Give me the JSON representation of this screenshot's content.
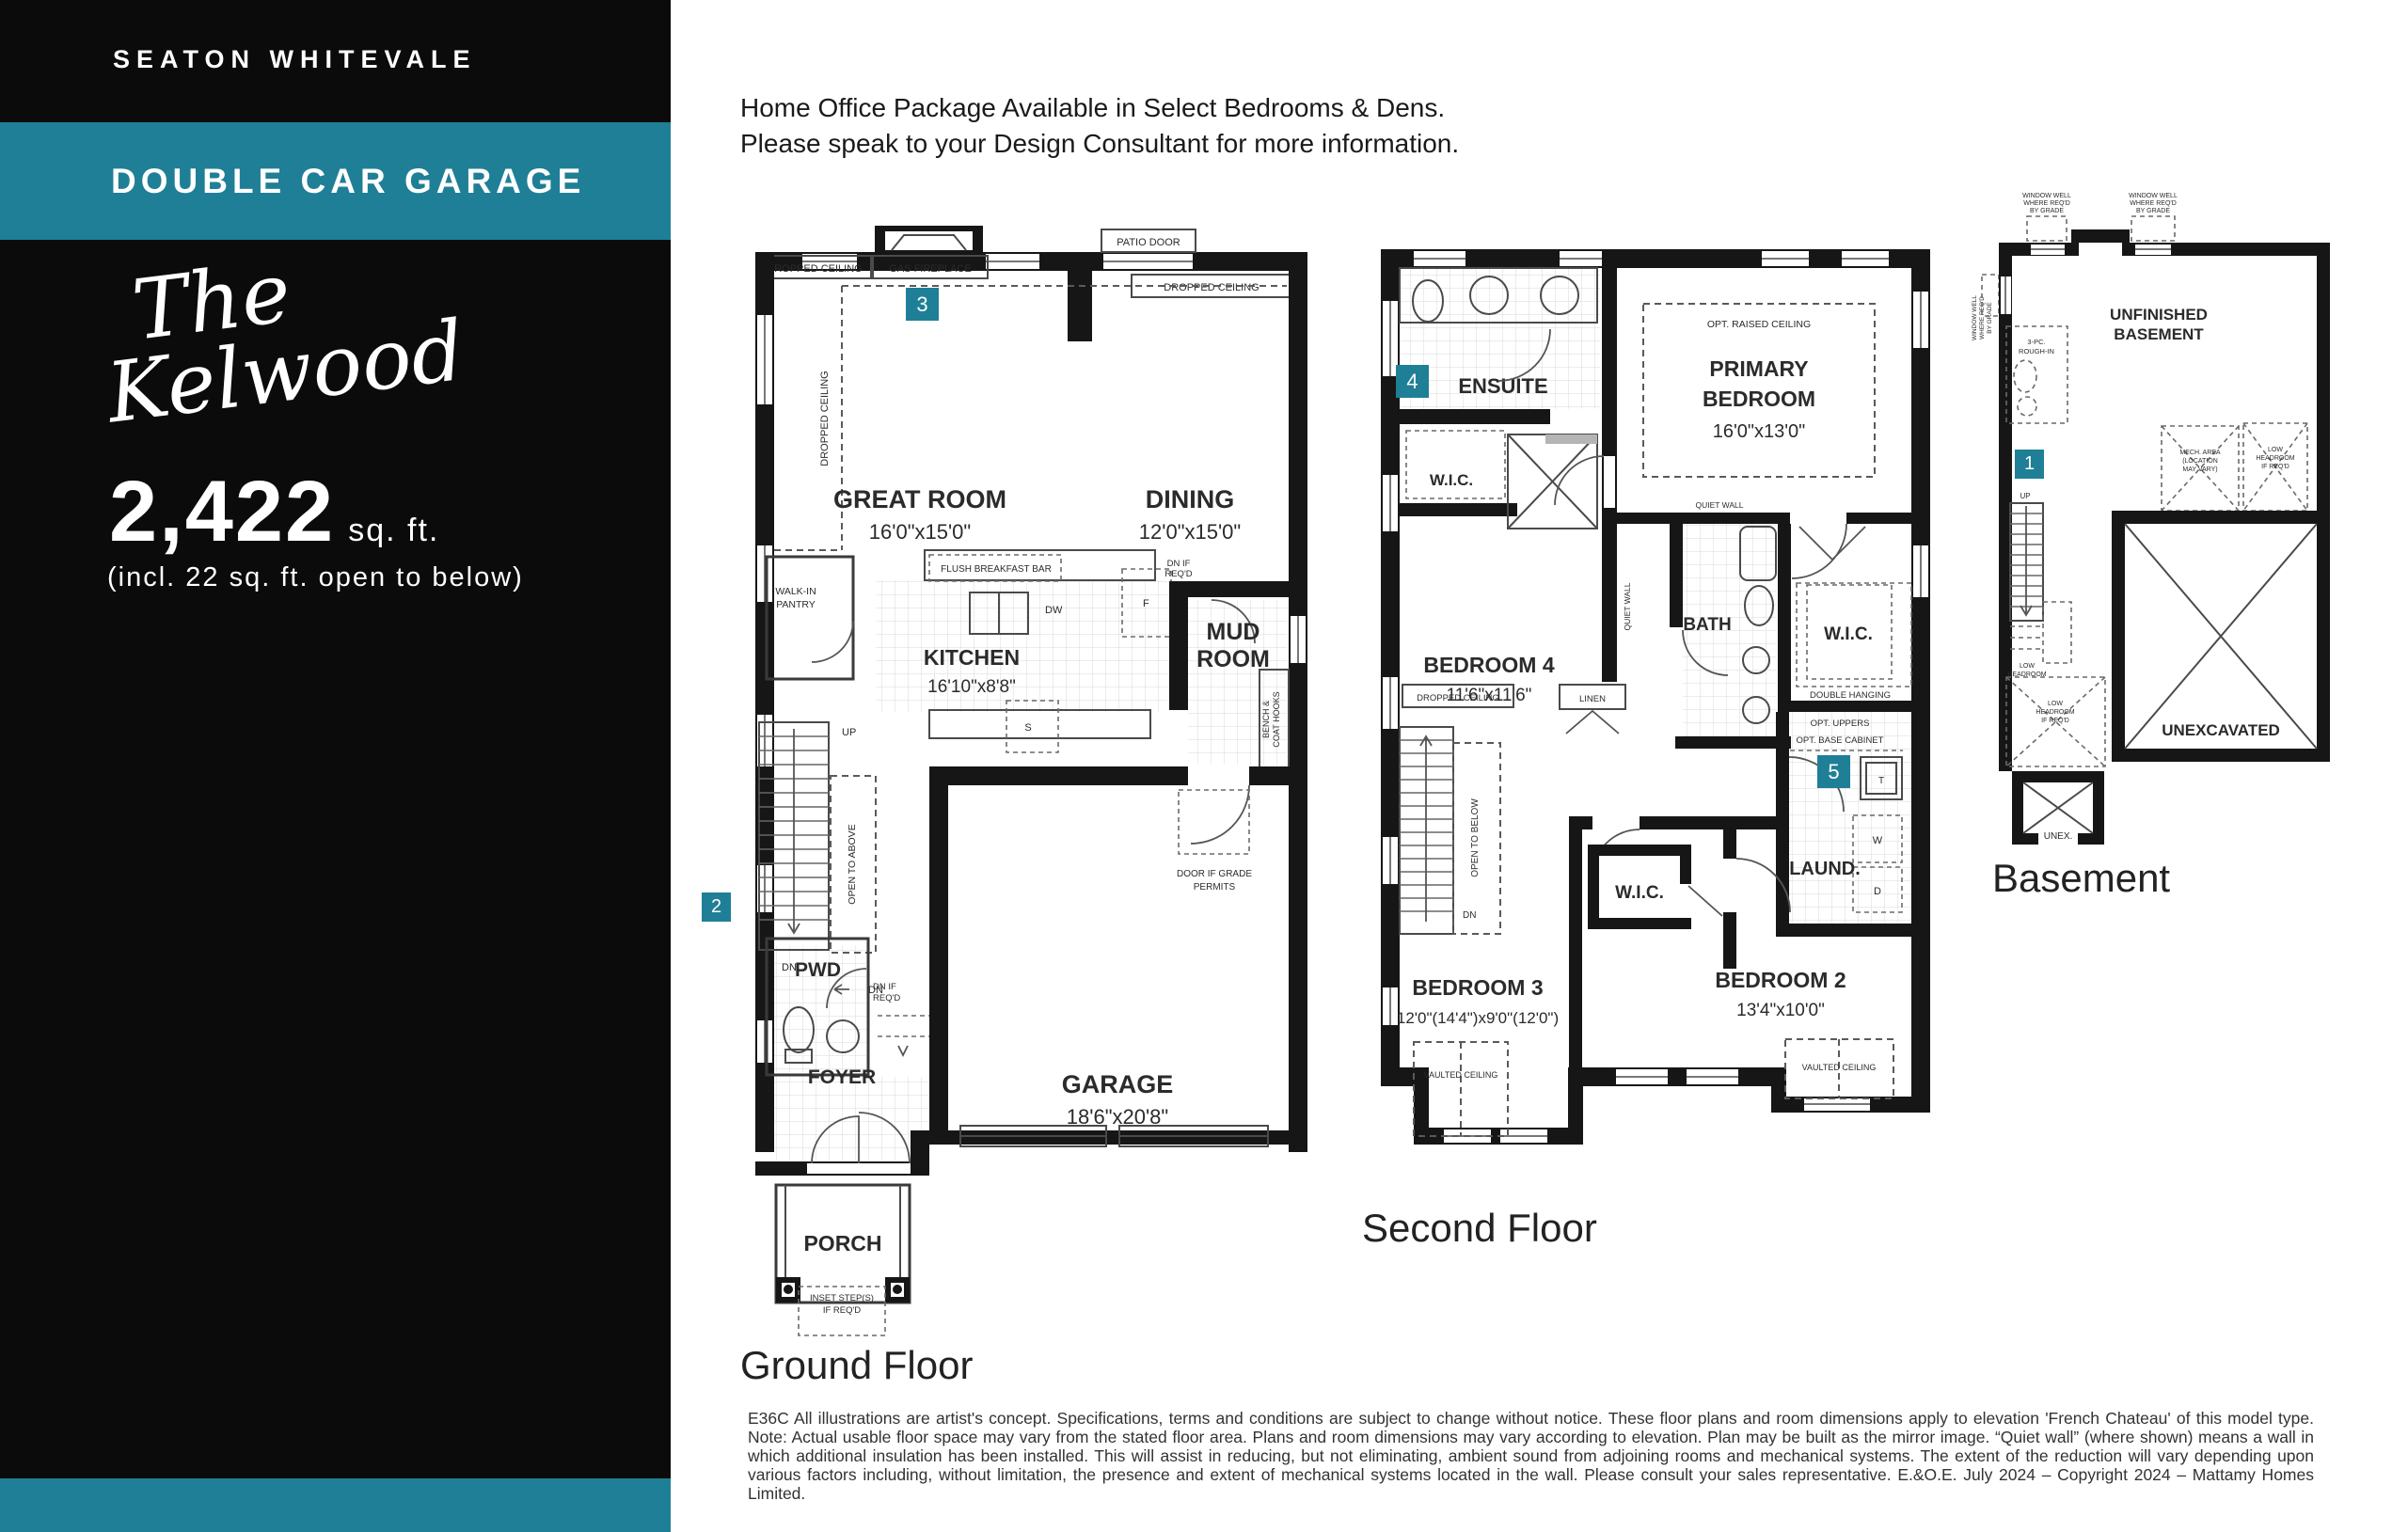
{
  "sidebar": {
    "community": "SEATON WHITEVALE",
    "banner": "DOUBLE CAR GARAGE",
    "model_script_line1": "The",
    "model_script_line2": "Kelwood",
    "sqft_value": "2,422",
    "sqft_unit": "sq. ft.",
    "sqft_note": "(incl. 22 sq. ft. open to below)",
    "colors": {
      "teal": "#1f7f96",
      "black": "#0b0b0b"
    }
  },
  "header": {
    "line1": "Home Office Package Available in Select Bedrooms & Dens.",
    "line2": "Please speak to your Design Consultant for more information."
  },
  "badges": {
    "b1": "1",
    "b2": "2",
    "b3": "3",
    "b4": "4",
    "b5": "5"
  },
  "ground_floor": {
    "caption": "Ground Floor",
    "labels": {
      "gas_fireplace": "GAS FIREPLACE",
      "patio_door": "PATIO DOOR",
      "dropped_ceiling_left": "DROPPED CEILING",
      "dropped_ceiling_right": "DROPPED CEILING",
      "dropped_ceiling_side": "DROPPED CEILING",
      "great_room": "GREAT ROOM",
      "great_room_dims": "16'0\"x15'0\"",
      "dining": "DINING",
      "dining_dims": "12'0\"x15'0\"",
      "walk_in_pantry_l1": "WALK-IN",
      "walk_in_pantry_l2": "PANTRY",
      "flush_breakfast_bar": "FLUSH BREAKFAST BAR",
      "kitchen": "KITCHEN",
      "kitchen_dims": "16'10\"x8'8\"",
      "dw": "DW",
      "fridge": "F",
      "stove": "S",
      "up": "UP",
      "dn1": "DN",
      "dn2": "DN",
      "open_to_above": "OPEN TO ABOVE",
      "dn_if_reqd_mud_l1": "DN  IF",
      "dn_if_reqd_mud_l2": "REQ'D",
      "mud_l1": "MUD",
      "mud_l2": "ROOM",
      "bench_l1": "BENCH &",
      "bench_l2": "COAT HOOKS",
      "door_if_grade_l1": "DOOR IF GRADE",
      "door_if_grade_l2": "PERMITS",
      "garage": "GARAGE",
      "garage_dims": "18'6\"x20'8\"",
      "pwd": "PWD",
      "dn_if_reqd2_l1": "DN IF",
      "dn_if_reqd2_l2": "REQ'D",
      "foyer": "FOYER",
      "porch": "PORCH",
      "inset_l1": "INSET STEP(S)",
      "inset_l2": "IF REQ'D"
    }
  },
  "second_floor": {
    "caption": "Second Floor",
    "labels": {
      "ensuite": "ENSUITE",
      "wic_primary": "W.I.C.",
      "opt_raised_ceiling": "OPT. RAISED CEILING",
      "primary_l1": "PRIMARY",
      "primary_l2": "BEDROOM",
      "primary_dims": "16'0\"x13'0\"",
      "quiet_wall_v": "QUIET WALL",
      "quiet_wall_h": "QUIET WALL",
      "bedroom4": "BEDROOM 4",
      "bedroom4_dims": "11'6\"x11'6\"",
      "bath": "BATH",
      "wic_right": "W.I.C.",
      "double_hanging": "DOUBLE HANGING",
      "dropped_ceiling": "DROPPED CEILING",
      "linen": "LINEN",
      "open_to_below": "OPEN  TO  BELOW",
      "dn": "DN",
      "wic_bed3": "W.I.C.",
      "opt_uppers": "OPT. UPPERS",
      "opt_base_cabinet": "OPT. BASE CABINET",
      "laundry": "LAUND.",
      "tank": "T",
      "washer": "W",
      "dryer": "D",
      "bedroom3": "BEDROOM 3",
      "bedroom3_dims": "12'0\"(14'4\")x9'0\"(12'0\")",
      "bedroom2": "BEDROOM 2",
      "bedroom2_dims": "13'4\"x10'0\"",
      "vaulted1": "VAULTED CEILING",
      "vaulted2": "VAULTED CEILING"
    }
  },
  "basement": {
    "caption": "Basement",
    "labels": {
      "window_well_a_l1": "WINDOW WELL",
      "window_well_a_l2": "WHERE REQ'D",
      "window_well_a_l3": "BY GRADE",
      "window_well_b_l1": "WINDOW WELL",
      "window_well_b_l2": "WHERE REQ'D",
      "window_well_b_l3": "BY GRADE",
      "window_well_side_l1": "WINDOW WELL",
      "window_well_side_l2": "WHERE REQ'D",
      "window_well_side_l3": "BY GRADE",
      "unfinished_l1": "UNFINISHED",
      "unfinished_l2": "BASEMENT",
      "rough_in_l1": "3-PC.",
      "rough_in_l2": "ROUGH-IN",
      "up": "UP",
      "mech_l1": "MECH. AREA",
      "mech_l2": "(LOCATION",
      "mech_l3": "MAY VARY)",
      "low_head_r_l1": "LOW",
      "low_head_r_l2": "HEADROOM",
      "low_head_r_l3": "IF REQ'D",
      "low_head_l1": "LOW",
      "low_head_l2": "HEADROOM",
      "low_head2_l1": "LOW",
      "low_head2_l2": "HEADROOM",
      "low_head2_l3": "IF REQ'D",
      "unexcavated": "UNEXCAVATED",
      "unex": "UNEX."
    }
  },
  "footer": {
    "disclaimer": "E36C All illustrations are artist's concept. Specifications, terms and conditions are subject to change without notice. These floor plans and room dimensions apply to elevation 'French Chateau' of this model type. Note: Actual usable floor space may vary from the stated floor area. Plans and room dimensions may vary according to elevation. Plan may be built as the mirror image. “Quiet wall” (where shown) means a wall in which additional insulation has been installed. This will assist in reducing, but not eliminating, ambient sound from adjoining rooms and mechanical systems. The extent of the reduction will vary depending upon various factors including, without limitation, the presence and extent of mechanical systems located in the wall. Please consult your sales representative. E.&O.E. July 2024 – Copyright 2024 – Mattamy Homes Limited."
  }
}
